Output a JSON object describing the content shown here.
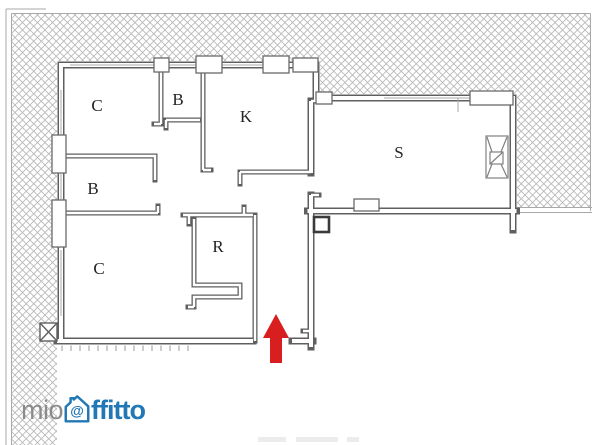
{
  "brand": {
    "name": "mioaffitto",
    "prefix": "mio",
    "suffix": "ffitto",
    "at_symbol": "@",
    "prefix_color": "#8b8b8b",
    "suffix_color": "#2277b5"
  },
  "floorplan": {
    "rooms": [
      {
        "id": "bedroom-top-left",
        "label": "C"
      },
      {
        "id": "bath-top",
        "label": "B"
      },
      {
        "id": "kitchen",
        "label": "K"
      },
      {
        "id": "living",
        "label": "S"
      },
      {
        "id": "bath-mid",
        "label": "B"
      },
      {
        "id": "bedroom-bottom-left",
        "label": "C"
      },
      {
        "id": "storage",
        "label": "R"
      }
    ],
    "entrance_arrow": {
      "direction": "up",
      "color": "#d81e1e"
    },
    "colors": {
      "walls": "#5f5f5f",
      "hatch": "#b6b6b6",
      "border": "#a8a8a8"
    }
  }
}
